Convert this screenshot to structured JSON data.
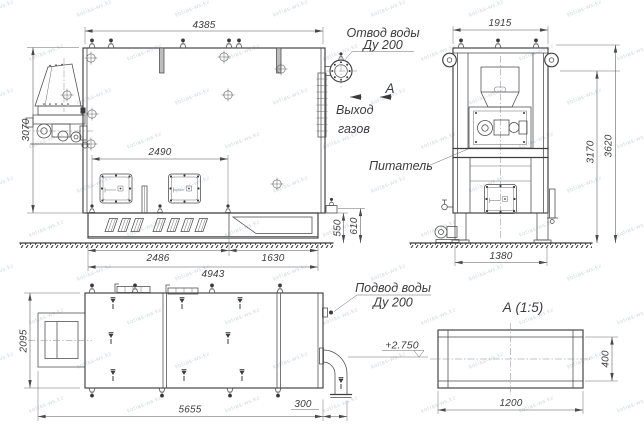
{
  "watermark": "kotlas-ws.kz",
  "labels": {
    "water_outlet_1": "Отвод воды",
    "water_outlet_2": "Ду 200",
    "view_letter": "А",
    "gas_outlet_1": "Выход",
    "gas_outlet_2": "газов",
    "feeder": "Питатель",
    "water_supply_1": "Подвод воды",
    "water_supply_2": "Ду 200",
    "section_title": "А (1:5)",
    "elevation": "+2.750"
  },
  "dims": {
    "overall_length": "4385",
    "body_height": "3070",
    "doors_span": "2490",
    "base_front": "2486",
    "base_rear": "1630",
    "base_total": "4943",
    "base_height": "550",
    "ledge_height": "610",
    "end_width": "1915",
    "end_height_mid": "3170",
    "end_height_total": "3620",
    "end_base_width": "1380",
    "plan_width": "2095",
    "plan_length": "5655",
    "pipe_stub": "300",
    "duct_width": "1200",
    "duct_height": "400"
  }
}
